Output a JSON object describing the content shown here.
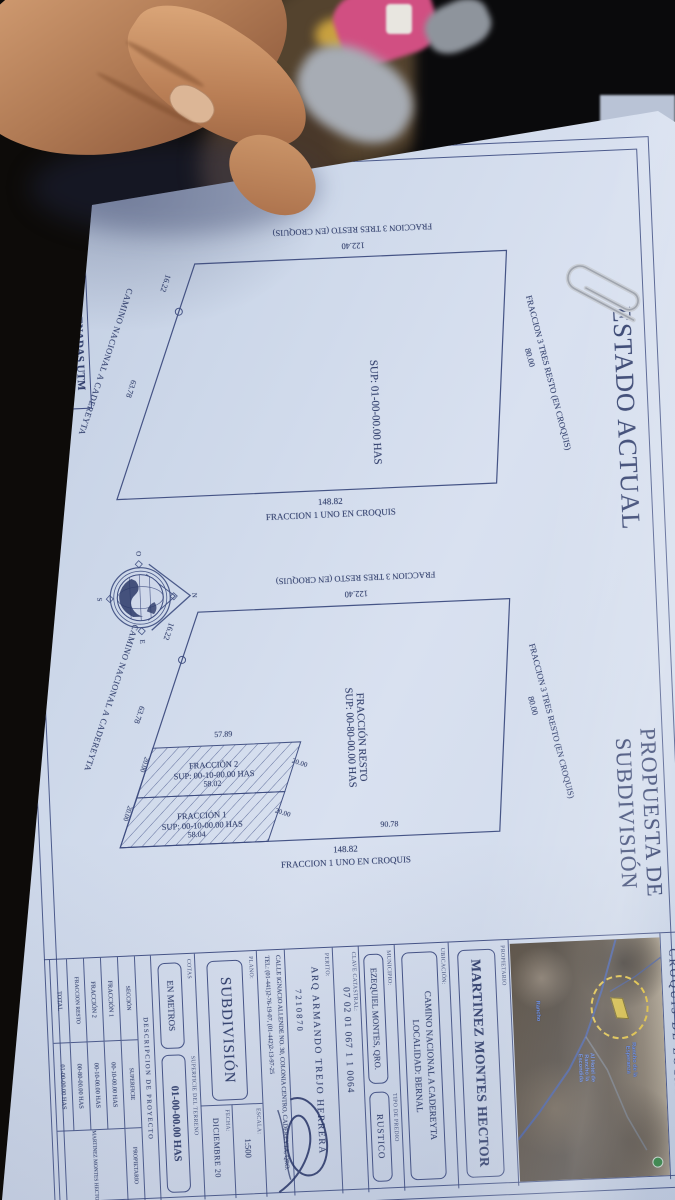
{
  "doc": {
    "sections": {
      "estado_title": "ESTADO ACTUAL",
      "propuesta_title1": "PROPUESTA DE",
      "propuesta_title2": "SUBDIVISIÓN"
    },
    "utm": {
      "header": "COORDENADAS UTM",
      "x": "X=401856.30",
      "y": "Y=2291156.75"
    },
    "parcel_common": {
      "top_neighbor": "FRACCION 3 TRES  RESTO (EN CROQUIS)",
      "top_dim": "80.00",
      "left_dim": "122.40",
      "left_neighbor": "FRACCION 3 TRES  RESTO (EN CROQUIS)",
      "right_dim": "148.82",
      "right_neighbor": "FRACCION 1 UNO EN CROQUIS",
      "road": "CAMINO NACIONAL A CADEREYTA",
      "road_dim1": "16.22",
      "road_dim2": "63.78"
    },
    "estado_parcel": {
      "sup": "SUP: 01-00-00.00  HAS"
    },
    "propuesta_parcel": {
      "resto_name": "FRACCIÓN RESTO",
      "resto_sup": "SUP: 00-80-00.00  HAS",
      "f2_name": "FRACCIÓN 2",
      "f2_sup": "SUP: 00-10-00.00 HAS",
      "f1_name": "FRACCIÓN 1",
      "f1_sup": "SUP: 00-10-00.00 HAS",
      "d_5789": "57.89",
      "d_5802": "58.02",
      "d_5804": "58.04",
      "d_9078": "90.78",
      "w20": "20.00"
    },
    "compass": {
      "n": "N",
      "s": "S",
      "e": "E",
      "o": "O"
    },
    "titleblock": {
      "croquis_header": "CROQUIS DE LOCALIZACIÓN",
      "map_labels": [
        "Rancho de la Esperanza",
        "Al Hotel de Rancho la Escondida",
        "Rancho"
      ],
      "propietario_label": "PROPIETARIO",
      "propietario": "MARTINEZ MONTES HECTOR",
      "ubicacion_label": "UBICACIÓN:",
      "ubicacion1": "CAMINO NACIONAL A CADEREYTA",
      "ubicacion2": "LOCALIDAD: BERNAL",
      "municipio_label": "MUNICIPIO:",
      "municipio": "EZEQUIEL MONTES, QRO.",
      "tipo_label": "TIPO DE PREDIO",
      "tipo": "RUSTICO",
      "clave_label": "CLAVE CATASTRAL:",
      "clave": "07 02 01 067 1 1 0064",
      "perito_label": "PERITO:",
      "perito": "ARQ ARMANDO TREJO HERRERA",
      "cedula": "7210870",
      "calle": "CALLE IGNACIO ALLENDE NO. 30, COLONIA CENTRO, CADEREYTA, QRO.",
      "tel": "TEL: (01-441)2-76-19-07, (01-442)2-13-97-25",
      "plano_label": "PLANO:",
      "plano": "SUBDIVISIÓN",
      "escala_label": "ESCALA:",
      "escala": "1:500",
      "fecha_label": "FECHA:",
      "fecha": "DICIEMBRE 20",
      "cotas_label": "COTAS",
      "cotas": "EN METROS",
      "superficie_label": "SUPERFICIE DEL TERRENO",
      "superficie": "01-00-00.00 HAS",
      "descripcion_header": "DESCRIPCION DE PROYECTO",
      "table": {
        "col_seccion": "SECCIÓN",
        "col_superficie": "SUPERFICIE",
        "col_propietario": "PROPIETARIO",
        "rows": [
          {
            "seccion": "FRACCIÓN 1",
            "superficie": "00-10-00.00 HAS"
          },
          {
            "seccion": "FRACCIÓN 2",
            "superficie": "00-10-00.00 HAS"
          },
          {
            "seccion": "FRACCION RESTO",
            "superficie": "00-80-00.00 HAS"
          },
          {
            "seccion": "TOTAL",
            "superficie": "01-00-00.00 HAS"
          }
        ],
        "propietario_cell": "MARTINEZ MONTES HECTOR"
      }
    }
  }
}
